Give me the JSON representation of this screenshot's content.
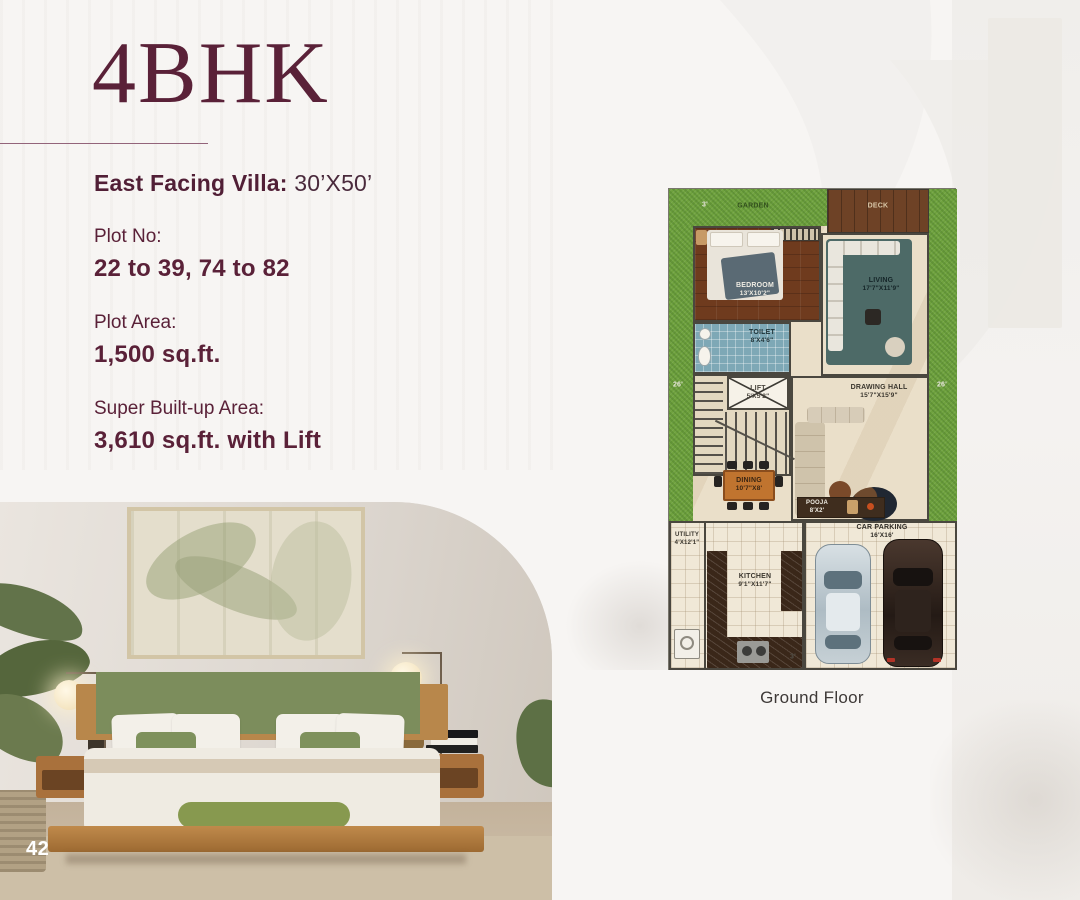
{
  "header": {
    "title": "4BHK",
    "subtitle_label": "East Facing Villa:",
    "subtitle_value": "30’X50’"
  },
  "details": [
    {
      "label": "Plot No:",
      "value": "22 to 39, 74 to 82"
    },
    {
      "label": "Plot Area:",
      "value": "1,500 sq.ft."
    },
    {
      "label": "Super Built-up Area:",
      "value": "3,610 sq.ft. with Lift"
    }
  ],
  "floor_plan": {
    "caption": "Ground Floor",
    "dimensions": {
      "top": "3'",
      "left": "26'",
      "right": "26'",
      "bottom": "3'"
    },
    "rooms": {
      "garden": {
        "name": "GARDEN"
      },
      "deck": {
        "name": "DECK"
      },
      "bedroom": {
        "name": "BEDROOM",
        "size": "13'X10'2\""
      },
      "living": {
        "name": "LIVING",
        "size": "17'7\"X11'9\""
      },
      "toilet": {
        "name": "TOILET",
        "size": "8'X4'6\""
      },
      "lift": {
        "name": "LIFT",
        "size": "5'X5'2\""
      },
      "stairs": {
        "label": "UP"
      },
      "drawing_hall": {
        "name": "DRAWING HALL",
        "size": "15'7\"X15'9\""
      },
      "dining": {
        "name": "DINING",
        "size": "10'7\"X8'"
      },
      "pooja": {
        "name": "POOJA",
        "size": "8'X2'"
      },
      "utility": {
        "name": "UTILITY",
        "size": "4'X12'1\""
      },
      "kitchen": {
        "name": "KITCHEN",
        "size": "9'1\"X11'7\""
      },
      "car_parking": {
        "name": "CAR PARKING",
        "size": "16'X16'"
      }
    }
  },
  "footer": {
    "page_number": "42"
  },
  "colors": {
    "brand_maroon": "#5A2138",
    "caption_gray": "#3E3937",
    "grass_green": "#6FA23E",
    "deck_wood": "#6E4226",
    "marble_cream": "#EADFC9",
    "toilet_blue": "#7EA8B6",
    "sofa_teal": "#4D6A67"
  }
}
